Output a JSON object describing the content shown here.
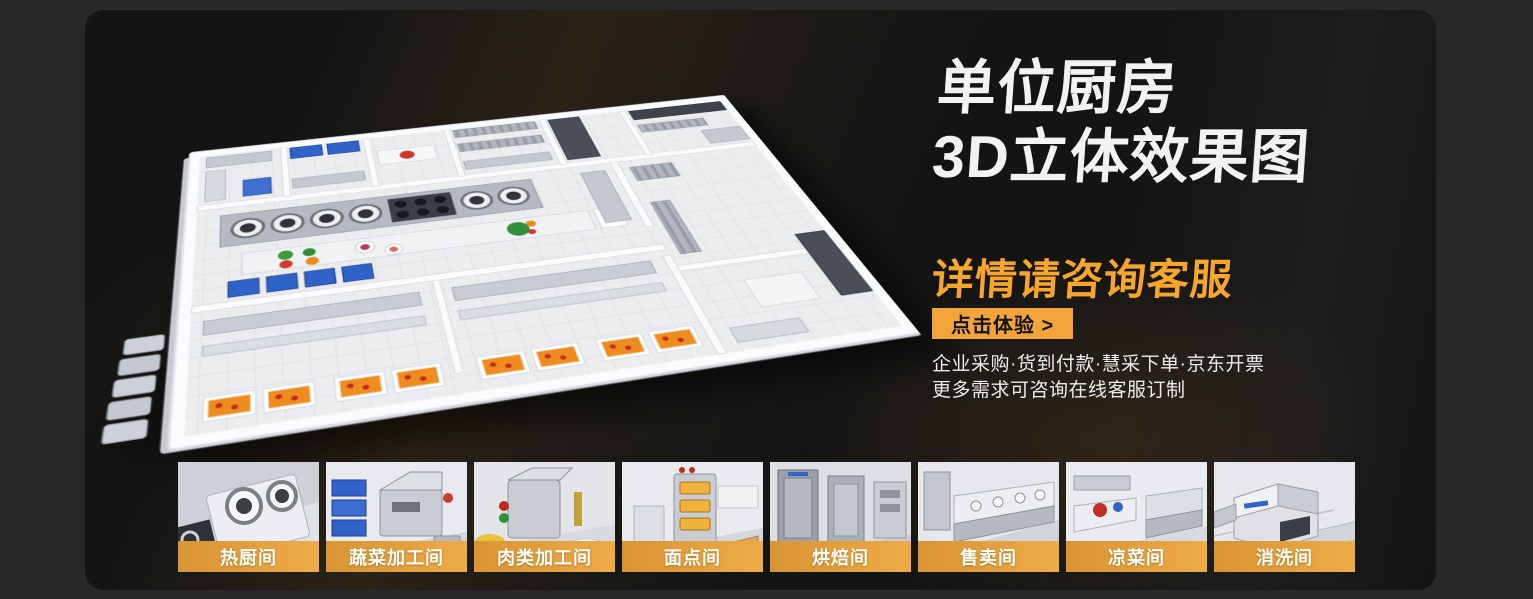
{
  "heading": {
    "line1": "单位厨房",
    "line2": "3D立体效果图",
    "subtitle": "详情请咨询客服"
  },
  "cta": {
    "label": "点击体验 >"
  },
  "info": {
    "line1": "企业采购·货到付款·慧采下单·京东开票",
    "line2": "更多需求可咨询在线客服订制"
  },
  "thumbnails": [
    {
      "name": "hot-kitchen",
      "label": "热厨间"
    },
    {
      "name": "vegetable-processing",
      "label": "蔬菜加工间"
    },
    {
      "name": "meat-processing",
      "label": "肉类加工间"
    },
    {
      "name": "pastry-room",
      "label": "面点间"
    },
    {
      "name": "baking-room",
      "label": "烘焙间"
    },
    {
      "name": "sales-room",
      "label": "售卖间"
    },
    {
      "name": "cold-dish-room",
      "label": "凉菜间"
    },
    {
      "name": "washing-room",
      "label": "消洗间"
    }
  ],
  "colors": {
    "accent": "#F5A62B",
    "button_bg": "#F2A33A",
    "label_band_start": "#D99433",
    "label_band_end": "#EDAB47",
    "card_bg": "#141414",
    "page_bg": "#282828"
  }
}
